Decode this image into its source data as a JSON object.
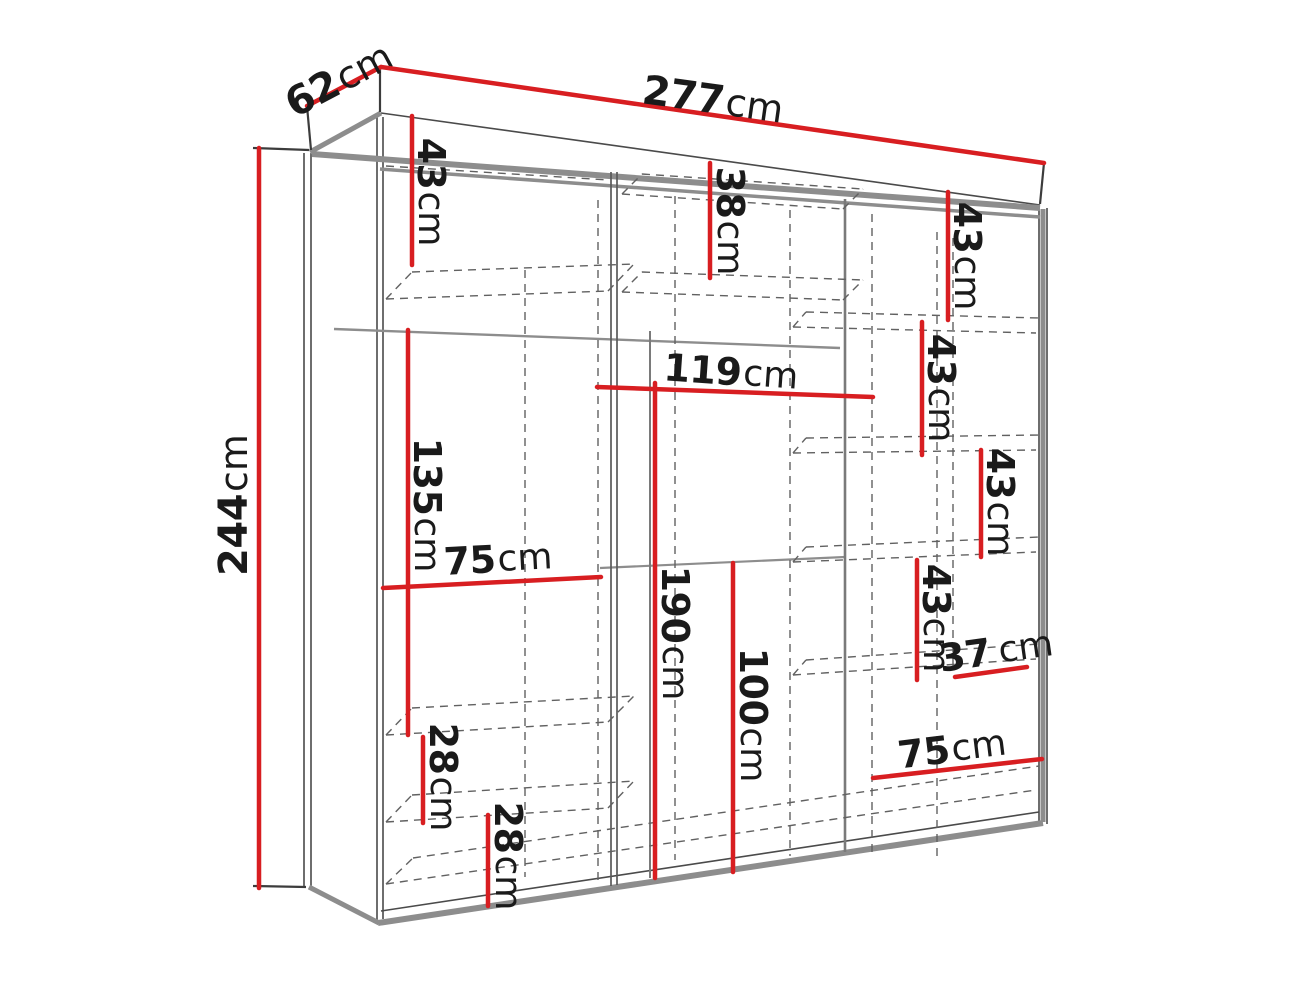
{
  "diagram": {
    "type": "furniture-dimension-diagram",
    "subject": "wardrobe-interior-dimensions",
    "background": "#ffffff",
    "unit": "cm",
    "colors": {
      "dimension_line": "#d81e21",
      "label_text": "#1a1a1a",
      "structure_gray": "#8d8d8d",
      "hidden_edge_dashed": "#616161"
    },
    "overall": {
      "width": "277cm",
      "depth": "62cm",
      "height": "244cm"
    },
    "dimensions": [
      {
        "name": "overall-depth",
        "value": "62",
        "unit": "cm",
        "text": "62cm",
        "line": [
          307,
          106,
          381,
          67
        ],
        "label": [
          339,
          80
        ],
        "rotation": -28,
        "size": 40
      },
      {
        "name": "overall-width",
        "value": "277",
        "unit": "cm",
        "text": "277cm",
        "line": [
          381,
          67,
          1044,
          163
        ],
        "label": [
          713,
          100
        ],
        "rotation": 8,
        "size": 40
      },
      {
        "name": "overall-height",
        "value": "244",
        "unit": "cm",
        "text": "244cm",
        "line": [
          259,
          148,
          259,
          888
        ],
        "label": [
          234,
          505
        ],
        "rotation": -90,
        "size": 40
      },
      {
        "name": "left-top-shelf-height",
        "value": "43",
        "unit": "cm",
        "text": "43cm",
        "line": [
          412,
          116,
          412,
          265
        ],
        "label": [
          431,
          192
        ],
        "rotation": 90,
        "size": 38
      },
      {
        "name": "middle-top-shelf-height",
        "value": "38",
        "unit": "cm",
        "text": "38cm",
        "line": [
          710,
          163,
          710,
          278
        ],
        "label": [
          730,
          221
        ],
        "rotation": 90,
        "size": 38
      },
      {
        "name": "right-shelf-1-height",
        "value": "43",
        "unit": "cm",
        "text": "43cm",
        "line": [
          948,
          192,
          948,
          320
        ],
        "label": [
          967,
          256
        ],
        "rotation": 90,
        "size": 38
      },
      {
        "name": "right-shelf-2-height",
        "value": "43",
        "unit": "cm",
        "text": "43cm",
        "line": [
          922,
          322,
          922,
          455
        ],
        "label": [
          941,
          388
        ],
        "rotation": 90,
        "size": 38
      },
      {
        "name": "right-shelf-3-height",
        "value": "43",
        "unit": "cm",
        "text": "43cm",
        "line": [
          981,
          450,
          981,
          557
        ],
        "label": [
          1000,
          502
        ],
        "rotation": 90,
        "size": 38
      },
      {
        "name": "right-shelf-4-height",
        "value": "43",
        "unit": "cm",
        "text": "43cm",
        "line": [
          917,
          560,
          917,
          680
        ],
        "label": [
          936,
          618
        ],
        "rotation": 90,
        "size": 38
      },
      {
        "name": "right-shelf-width-37",
        "value": "37",
        "unit": "cm",
        "text": "37 cm",
        "line": [
          955,
          677,
          1027,
          667
        ],
        "label": [
          996,
          651
        ],
        "rotation": -8,
        "size": 38
      },
      {
        "name": "right-bottom-width-75",
        "value": "75",
        "unit": "cm",
        "text": "75cm",
        "line": [
          873,
          778,
          1042,
          759
        ],
        "label": [
          952,
          749
        ],
        "rotation": -7,
        "size": 38
      },
      {
        "name": "middle-shelf-width-119",
        "value": "119",
        "unit": "cm",
        "text": "119cm",
        "line": [
          597,
          387,
          873,
          397
        ],
        "label": [
          731,
          372
        ],
        "rotation": 4,
        "size": 38
      },
      {
        "name": "left-hanging-height-135",
        "value": "135",
        "unit": "cm",
        "text": "135cm",
        "line": [
          408,
          330,
          408,
          735
        ],
        "label": [
          427,
          505
        ],
        "rotation": 90,
        "size": 38
      },
      {
        "name": "left-section-width-75",
        "value": "75",
        "unit": "cm",
        "text": "75cm",
        "line": [
          383,
          588,
          601,
          577
        ],
        "label": [
          498,
          559
        ],
        "rotation": -3,
        "size": 38
      },
      {
        "name": "middle-hanging-height-190",
        "value": "190",
        "unit": "cm",
        "text": "190cm",
        "line": [
          655,
          383,
          655,
          878
        ],
        "label": [
          675,
          633
        ],
        "rotation": 90,
        "size": 38
      },
      {
        "name": "middle-hanging-height-100",
        "value": "100",
        "unit": "cm",
        "text": "100cm",
        "line": [
          733,
          563,
          733,
          872
        ],
        "label": [
          753,
          715
        ],
        "rotation": 90,
        "size": 38
      },
      {
        "name": "left-drawer-gap-28-upper",
        "value": "28",
        "unit": "cm",
        "text": "28cm",
        "line": [
          423,
          737,
          423,
          823
        ],
        "label": [
          443,
          777
        ],
        "rotation": 90,
        "size": 38
      },
      {
        "name": "left-drawer-gap-28-lower",
        "value": "28",
        "unit": "cm",
        "text": "28cm",
        "line": [
          488,
          815,
          488,
          906
        ],
        "label": [
          508,
          856
        ],
        "rotation": 90,
        "size": 38
      }
    ]
  }
}
